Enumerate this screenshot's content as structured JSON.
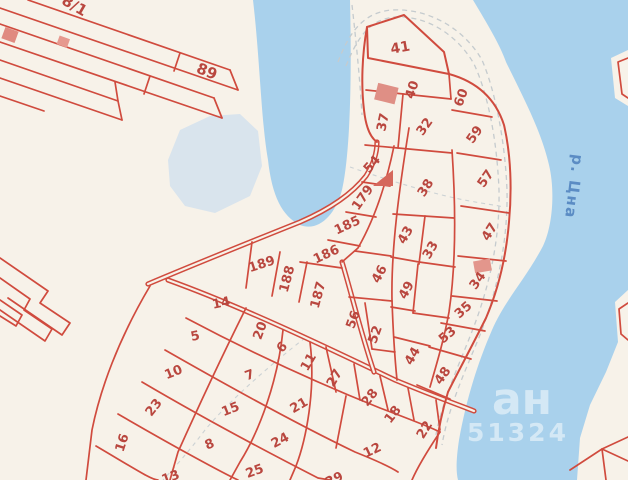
{
  "map": {
    "background_color": "#f7f2e9",
    "water_color": "#a9d1ec",
    "pond_color": "#d9e4ed",
    "line_color": "#d04b3e",
    "label_color": "#b9473f",
    "river_label": {
      "text": "р. Цна",
      "color": "#5b8cc4",
      "x": 569,
      "y": 186,
      "rotation": 97,
      "size": 15
    },
    "watermark": {
      "line1": "ан",
      "line2": "51324",
      "color": "#ffffff",
      "opacity": 0.5
    },
    "parcel_labels": [
      {
        "t": "8/1",
        "x": 72,
        "y": 10,
        "r": 30,
        "s": 15
      },
      {
        "t": "89",
        "x": 205,
        "y": 76,
        "r": 22,
        "s": 15
      },
      {
        "t": "41",
        "x": 401,
        "y": 52,
        "r": -10,
        "s": 14
      },
      {
        "t": "40",
        "x": 416,
        "y": 91,
        "r": -72
      },
      {
        "t": "37",
        "x": 387,
        "y": 123,
        "r": -78
      },
      {
        "t": "32",
        "x": 428,
        "y": 129,
        "r": -55
      },
      {
        "t": "60",
        "x": 465,
        "y": 99,
        "r": -70
      },
      {
        "t": "59",
        "x": 478,
        "y": 137,
        "r": -55
      },
      {
        "t": "57",
        "x": 489,
        "y": 181,
        "r": -55
      },
      {
        "t": "47",
        "x": 493,
        "y": 234,
        "r": -58
      },
      {
        "t": "34",
        "x": 481,
        "y": 283,
        "r": -55
      },
      {
        "t": "35",
        "x": 466,
        "y": 313,
        "r": -42
      },
      {
        "t": "53",
        "x": 450,
        "y": 338,
        "r": -40
      },
      {
        "t": "44",
        "x": 416,
        "y": 358,
        "r": -60
      },
      {
        "t": "48",
        "x": 446,
        "y": 378,
        "r": -55
      },
      {
        "t": "38",
        "x": 429,
        "y": 190,
        "r": -57
      },
      {
        "t": "43",
        "x": 409,
        "y": 237,
        "r": -60
      },
      {
        "t": "33",
        "x": 434,
        "y": 252,
        "r": -60
      },
      {
        "t": "46",
        "x": 383,
        "y": 276,
        "r": -62
      },
      {
        "t": "49",
        "x": 410,
        "y": 292,
        "r": -62
      },
      {
        "t": "56",
        "x": 357,
        "y": 321,
        "r": -70
      },
      {
        "t": "52",
        "x": 379,
        "y": 336,
        "r": -70
      },
      {
        "t": "54",
        "x": 375,
        "y": 167,
        "r": -48
      },
      {
        "t": "179",
        "x": 366,
        "y": 200,
        "r": -55
      },
      {
        "t": "185",
        "x": 349,
        "y": 229,
        "r": -25
      },
      {
        "t": "186",
        "x": 328,
        "y": 258,
        "r": -25
      },
      {
        "t": "187",
        "x": 322,
        "y": 296,
        "r": -75
      },
      {
        "t": "188",
        "x": 291,
        "y": 280,
        "r": -75
      },
      {
        "t": "189",
        "x": 263,
        "y": 268,
        "r": -18
      },
      {
        "t": "14",
        "x": 222,
        "y": 307,
        "r": -12
      },
      {
        "t": "5",
        "x": 196,
        "y": 340,
        "r": -12
      },
      {
        "t": "10",
        "x": 175,
        "y": 376,
        "r": -22
      },
      {
        "t": "23",
        "x": 157,
        "y": 410,
        "r": -52
      },
      {
        "t": "16",
        "x": 126,
        "y": 444,
        "r": -72
      },
      {
        "t": "20",
        "x": 264,
        "y": 332,
        "r": -70
      },
      {
        "t": "6",
        "x": 285,
        "y": 350,
        "r": -48
      },
      {
        "t": "11",
        "x": 312,
        "y": 364,
        "r": -60
      },
      {
        "t": "27",
        "x": 338,
        "y": 380,
        "r": -60
      },
      {
        "t": "7",
        "x": 251,
        "y": 379,
        "r": -20
      },
      {
        "t": "21",
        "x": 301,
        "y": 409,
        "r": -30
      },
      {
        "t": "28",
        "x": 373,
        "y": 400,
        "r": -52
      },
      {
        "t": "18",
        "x": 396,
        "y": 417,
        "r": -52
      },
      {
        "t": "22",
        "x": 428,
        "y": 432,
        "r": -58
      },
      {
        "t": "12",
        "x": 374,
        "y": 454,
        "r": -25
      },
      {
        "t": "15",
        "x": 232,
        "y": 413,
        "r": -22
      },
      {
        "t": "24",
        "x": 282,
        "y": 444,
        "r": -28
      },
      {
        "t": "8",
        "x": 211,
        "y": 448,
        "r": -22
      },
      {
        "t": "25",
        "x": 256,
        "y": 475,
        "r": -20
      },
      {
        "t": "13",
        "x": 172,
        "y": 481,
        "r": -20
      },
      {
        "t": "29",
        "x": 336,
        "y": 483,
        "r": -25
      }
    ]
  }
}
